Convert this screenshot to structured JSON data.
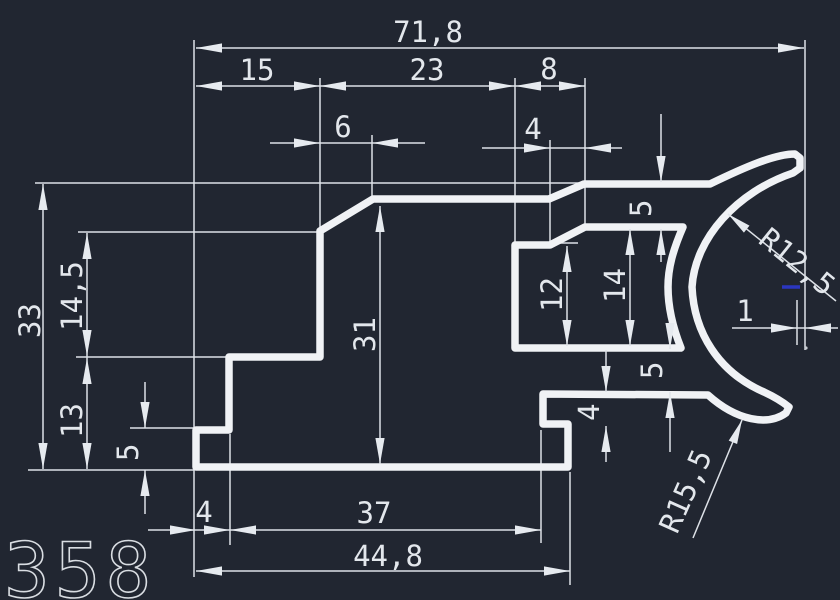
{
  "canvas": {
    "background": "#212631",
    "profile_line_color": "#f0f2f5",
    "dimension_line_color": "#dde1e7",
    "snap_marker_color": "#2b36c0"
  },
  "drawing": {
    "part_number": "358",
    "dims": {
      "overall_width": "71,8",
      "top_seg_left": "15",
      "top_seg_mid": "23",
      "top_seg_right": "8",
      "chamfer_run_left": "6",
      "chamfer_run_right": "4",
      "height_overall": "33",
      "height_upper": "14,5",
      "height_lower": "13",
      "step_height_left": "5",
      "web_height": "31",
      "tongue_inner_height": "12",
      "tongue_outer_height": "14",
      "gap_top": "5",
      "gap_bottom": "5",
      "flange_thickness": "4",
      "edge_offset": "1",
      "radius_inner": "R12,5",
      "radius_outer": "R15,5",
      "bottom_seg_left": "4",
      "bottom_seg_mid": "37",
      "bottom_width": "44,8"
    }
  }
}
